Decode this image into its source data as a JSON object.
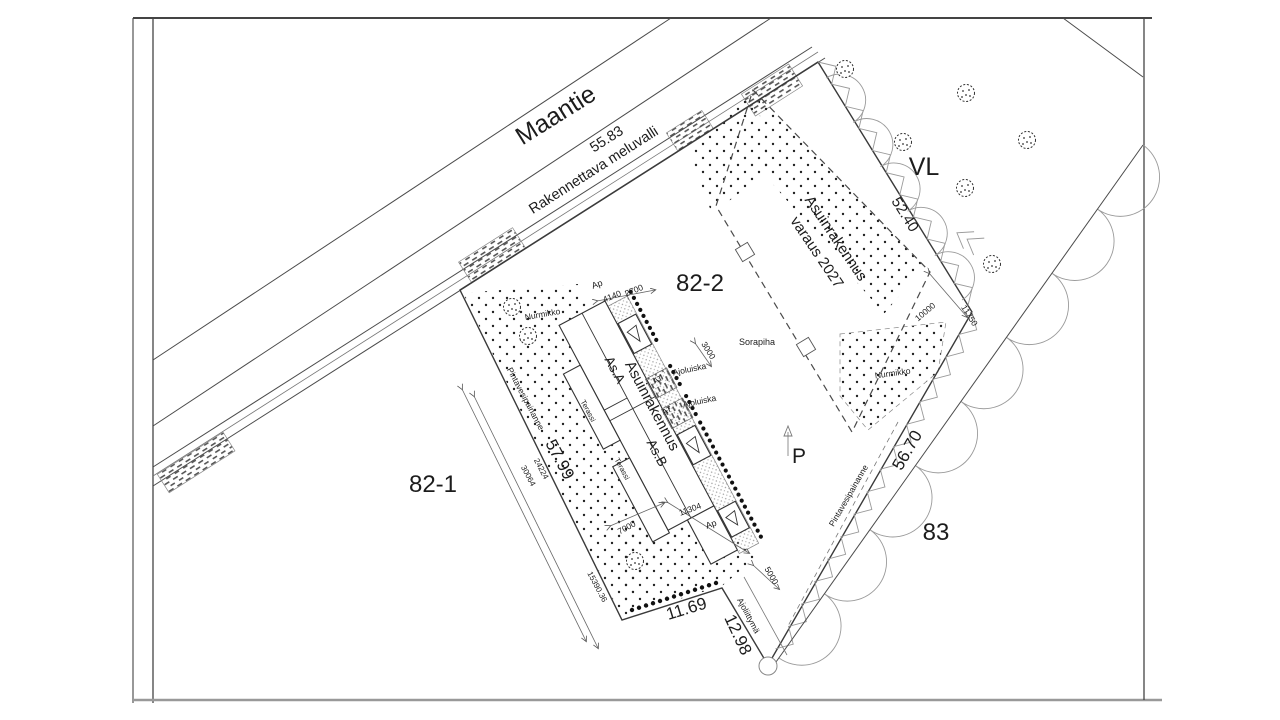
{
  "drawing": {
    "kind": "site-plan",
    "road_name": "Maantie",
    "parcels": [
      "82-1",
      "82-2",
      "83"
    ],
    "zones": [
      "VL"
    ],
    "boundary_lengths": [
      "55.83",
      "52.40",
      "56.70",
      "57.99",
      "11.69",
      "12.98"
    ]
  },
  "colors": {
    "paper": "#ffffff",
    "ink": "#1c1c1c",
    "line": "#3a3a3a",
    "hatch": "#8a8a8a"
  },
  "labels": [
    {
      "name": "road-name",
      "text": "Maantie",
      "x": 560,
      "y": 122,
      "r": -32,
      "s": 25
    },
    {
      "name": "dim-55-83",
      "text": "55.83",
      "x": 609,
      "y": 143,
      "r": -32.5,
      "s": 14.5
    },
    {
      "name": "noise-barrier-label",
      "text": "Rakennettava meluvalli",
      "x": 596,
      "y": 174,
      "r": -32.5,
      "s": 14.5
    },
    {
      "name": "parcel-82-2",
      "text": "82-2",
      "x": 700,
      "y": 291,
      "r": 0,
      "s": 24
    },
    {
      "name": "parcel-82-1",
      "text": "82-1",
      "x": 433,
      "y": 492,
      "r": 0,
      "s": 24
    },
    {
      "name": "parcel-83",
      "text": "83",
      "x": 936,
      "y": 540,
      "r": 0,
      "s": 24
    },
    {
      "name": "area-vl",
      "text": "VL",
      "x": 924,
      "y": 175,
      "r": 0,
      "s": 25
    },
    {
      "name": "ap-label-top",
      "text": "Ap",
      "x": 598,
      "y": 287,
      "r": -20,
      "s": 9
    },
    {
      "name": "dim-4140",
      "text": "4140",
      "x": 613,
      "y": 299,
      "r": -22,
      "s": 8.5
    },
    {
      "name": "dim-2700",
      "text": "2700",
      "x": 635,
      "y": 293,
      "r": -22,
      "s": 8.5
    },
    {
      "name": "lawn-label-left",
      "text": "Nurmikko",
      "x": 543,
      "y": 317,
      "r": -10,
      "s": 8.5
    },
    {
      "name": "swale-label-left",
      "text": "Pintavesipainanne",
      "x": 523,
      "y": 400,
      "r": 62,
      "s": 8.5
    },
    {
      "name": "dim-57-99",
      "text": "57.99",
      "x": 555,
      "y": 462,
      "r": 62,
      "s": 17
    },
    {
      "name": "dim-24224",
      "text": "24224",
      "x": 539,
      "y": 470,
      "r": 62,
      "s": 8
    },
    {
      "name": "dim-30064",
      "text": "30064",
      "x": 526,
      "y": 477,
      "r": 62,
      "s": 8
    },
    {
      "name": "dim-15390-36",
      "text": "15390.36",
      "x": 595,
      "y": 588,
      "r": 62,
      "s": 8
    },
    {
      "name": "unit-as-a",
      "text": "As.A",
      "x": 611,
      "y": 372,
      "r": 62,
      "s": 13.5
    },
    {
      "name": "building-label",
      "text": "Asuinrakennus",
      "x": 648,
      "y": 408,
      "r": 62,
      "s": 15
    },
    {
      "name": "unit-as-b",
      "text": "As.B",
      "x": 653,
      "y": 455,
      "r": 62,
      "s": 13.5
    },
    {
      "name": "terrace-label-1",
      "text": "Terassi",
      "x": 586,
      "y": 412,
      "r": 62,
      "s": 7.5
    },
    {
      "name": "terrace-label-2",
      "text": "Terassi",
      "x": 620,
      "y": 470,
      "r": 62,
      "s": 7.5
    },
    {
      "name": "at-label-1",
      "text": "AT",
      "x": 659,
      "y": 382,
      "r": -25,
      "s": 8
    },
    {
      "name": "ramp-label-1",
      "text": "Ajoluiska",
      "x": 690,
      "y": 372,
      "r": -12,
      "s": 8.5
    },
    {
      "name": "at-label-2",
      "text": "AT",
      "x": 668,
      "y": 413,
      "r": -25,
      "s": 8
    },
    {
      "name": "ramp-label-2",
      "text": "Ajoluiska",
      "x": 700,
      "y": 404,
      "r": -12,
      "s": 8.5
    },
    {
      "name": "dim-3000",
      "text": "3000",
      "x": 706,
      "y": 352,
      "r": 58,
      "s": 8.5
    },
    {
      "name": "gravel-yard-label",
      "text": "Sorapiha",
      "x": 757,
      "y": 345,
      "r": 0,
      "s": 9
    },
    {
      "name": "future-building-line1",
      "text": "Asuinrakennus",
      "x": 832,
      "y": 241,
      "r": 56,
      "s": 15
    },
    {
      "name": "future-building-line2",
      "text": "varaus 2027",
      "x": 813,
      "y": 255,
      "r": 56,
      "s": 15
    },
    {
      "name": "lawn-label-right",
      "text": "Nurmikko",
      "x": 893,
      "y": 376,
      "r": -8,
      "s": 8.5
    },
    {
      "name": "dim-52-40",
      "text": "52.40",
      "x": 901,
      "y": 217,
      "r": 58,
      "s": 15
    },
    {
      "name": "dim-10000",
      "text": "10000",
      "x": 927,
      "y": 314,
      "r": -40,
      "s": 8.5
    },
    {
      "name": "dim-11750",
      "text": "11750",
      "x": 967,
      "y": 317,
      "r": 58,
      "s": 8.5
    },
    {
      "name": "dim-56-70",
      "text": "56.70",
      "x": 912,
      "y": 453,
      "r": -60,
      "s": 17
    },
    {
      "name": "swale-label-right",
      "text": "Pintavesipainanne",
      "x": 851,
      "y": 497,
      "r": -60,
      "s": 8.5
    },
    {
      "name": "north-letter",
      "text": "P",
      "x": 799,
      "y": 463,
      "r": 0,
      "s": 21
    },
    {
      "name": "dim-7000",
      "text": "7000",
      "x": 628,
      "y": 530,
      "r": -28,
      "s": 8.5
    },
    {
      "name": "dim-11304",
      "text": "11304",
      "x": 691,
      "y": 512,
      "r": -20,
      "s": 8.5
    },
    {
      "name": "ap-label-bottom",
      "text": "Ap",
      "x": 712,
      "y": 527,
      "r": -20,
      "s": 9
    },
    {
      "name": "dim-5000",
      "text": "5000",
      "x": 769,
      "y": 577,
      "r": 60,
      "s": 8.5
    },
    {
      "name": "driveway-label",
      "text": "Ajoliittymä",
      "x": 746,
      "y": 617,
      "r": 62,
      "s": 8.5
    },
    {
      "name": "dim-11-69",
      "text": "11.69",
      "x": 688,
      "y": 614,
      "r": -17,
      "s": 17
    },
    {
      "name": "dim-12-98",
      "text": "12.98",
      "x": 733,
      "y": 637,
      "r": 65,
      "s": 17
    }
  ],
  "trees": [
    [
      512,
      307
    ],
    [
      528,
      336
    ],
    [
      635,
      561
    ],
    [
      845,
      69
    ],
    [
      903,
      142
    ],
    [
      966,
      93
    ],
    [
      1027,
      140
    ],
    [
      965,
      188
    ],
    [
      992,
      264
    ]
  ]
}
